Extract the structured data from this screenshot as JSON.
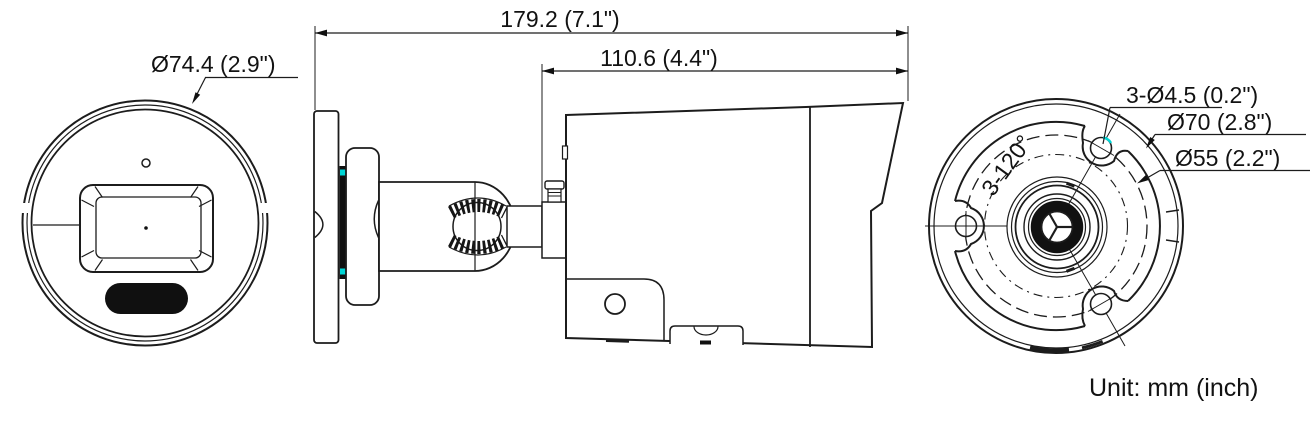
{
  "drawing": {
    "title": "bullet-camera-dimension-drawing",
    "unit_note": "Unit: mm (inch)",
    "colors": {
      "line": "#1c1c1c",
      "accent_cyan": "#00d6d6",
      "background": "#ffffff"
    },
    "front": {
      "diameter": "Ø74.4 (2.9\")"
    },
    "side": {
      "overall_length": "179.2 (7.1\")",
      "front_length": "110.6 (4.4\")"
    },
    "rear": {
      "screw_holes": "3-Ø4.5 (0.2\")",
      "outer_circle": "Ø70 (2.8\")",
      "inner_circle": "Ø55 (2.2\")",
      "hole_angle": "3-120°"
    }
  }
}
